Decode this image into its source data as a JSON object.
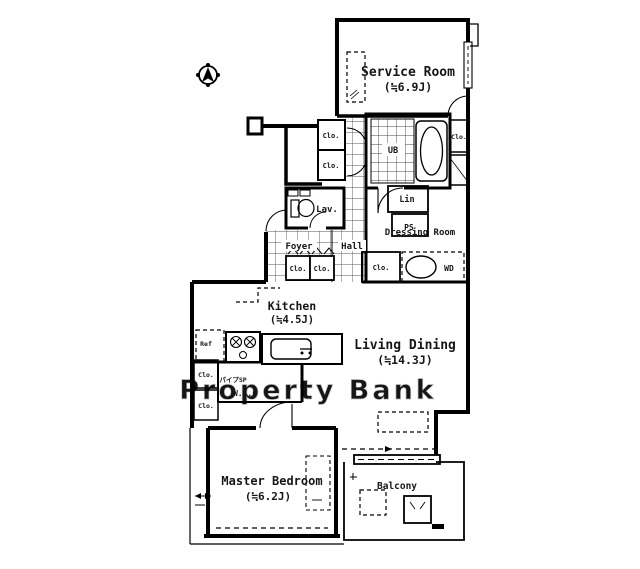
{
  "colors": {
    "background": "#ffffff",
    "line": "#000000",
    "watermark": "#d7d7d7"
  },
  "watermark": {
    "text": "Property Bank"
  },
  "rooms": {
    "service_room": {
      "label": "Service Room",
      "size": "(≒6.9J)"
    },
    "living_dining": {
      "label": "Living Dining",
      "size": "(≒14.3J)"
    },
    "kitchen": {
      "label": "Kitchen",
      "size": "(≒4.5J)"
    },
    "master_bedroom": {
      "label": "Master Bedroom",
      "size": "(≒6.2J)"
    },
    "balcony": {
      "label": "Balcony"
    },
    "dressing_room": {
      "label": "Dressing Room"
    },
    "foyer": {
      "label": "Foyer"
    },
    "hall": {
      "label": "Hall"
    },
    "lavatory": {
      "label": "Lav."
    },
    "walk_in_closet": {
      "label": "W.I.C"
    },
    "pipe_space_jp": {
      "label": "パイプSP"
    }
  },
  "labels": {
    "closet": "Clo.",
    "unit_bath": "UB",
    "linen": "Lin",
    "pipe_shaft": "PS",
    "refrigerator": "Ref",
    "washer_dryer": "WD"
  }
}
